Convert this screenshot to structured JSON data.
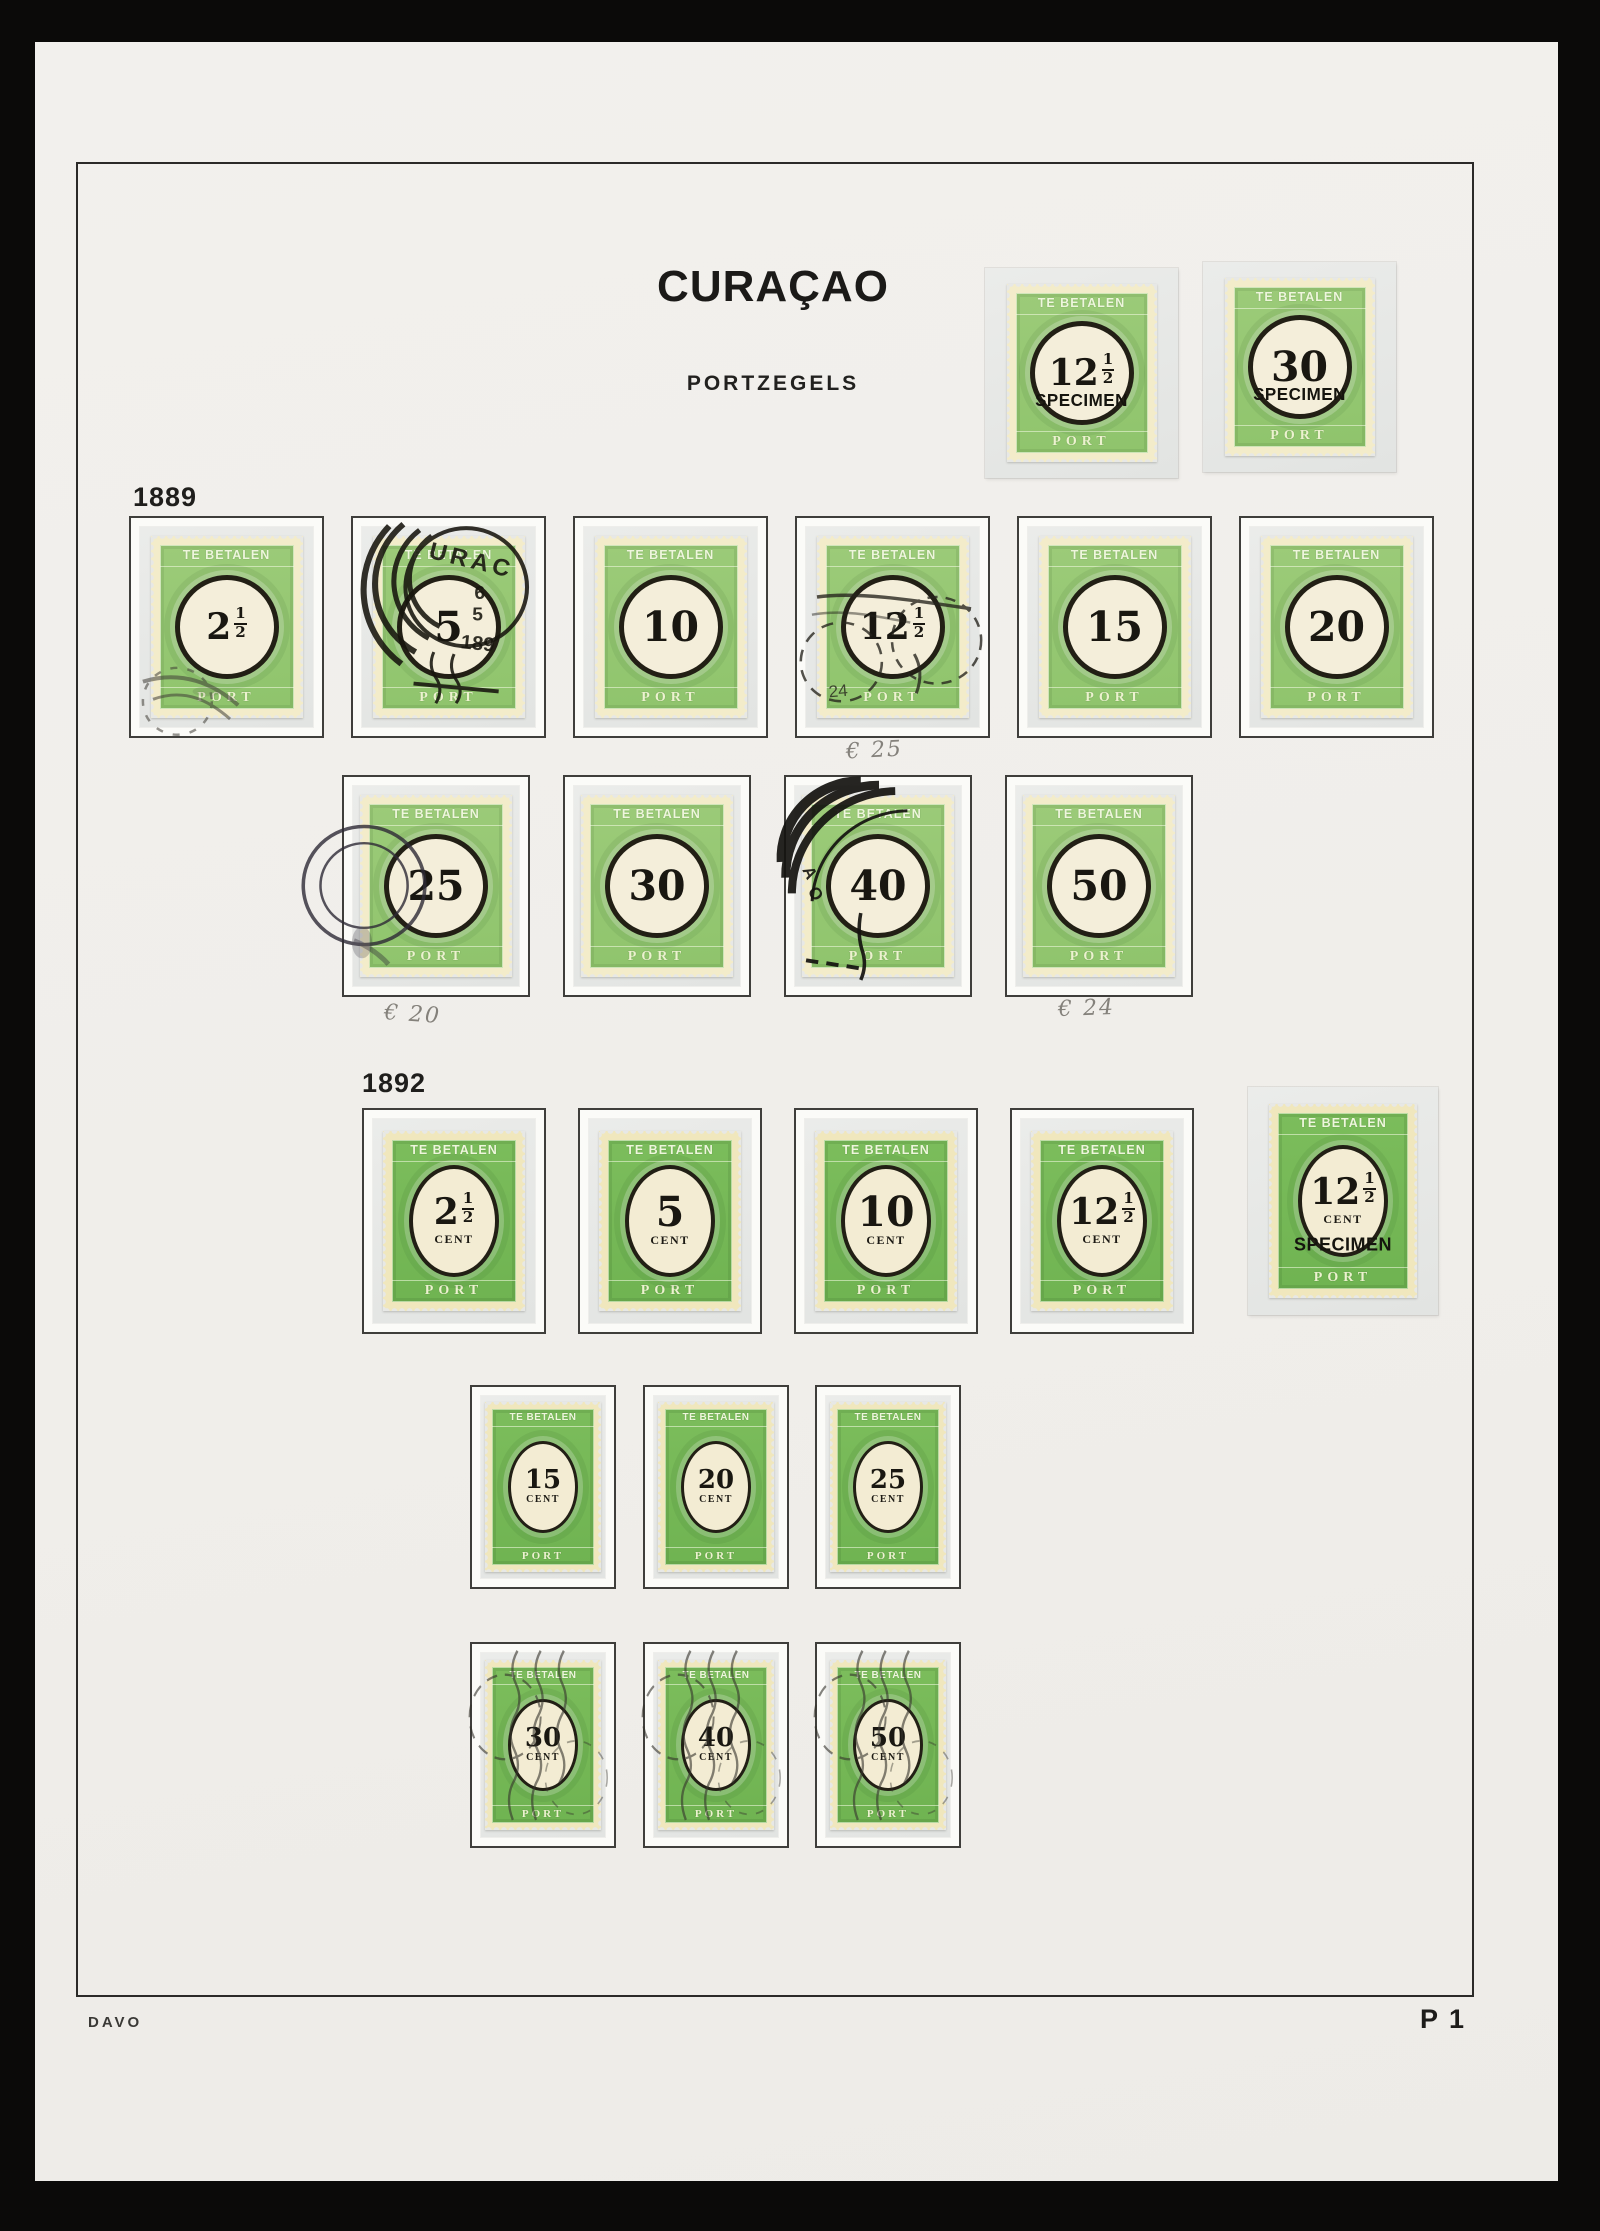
{
  "album": {
    "title": "CURAÇAO",
    "subtitle": "PORTZEGELS",
    "footer_left": "DAVO",
    "footer_right": "P 1"
  },
  "stamp_text": {
    "top": "TE BETALEN",
    "bottom": "PORT",
    "specimen": "SPECIMEN",
    "unit": "CENT"
  },
  "colors": {
    "backdrop": "#0b0a09",
    "page": "#f1efec",
    "frame_line": "#2b2a28",
    "box_border": "#3f3e3b",
    "mount": "#e7e8e6",
    "green_1889": "#95c672",
    "green_1892": "#75b756",
    "stamp_cream": "#f2eac6",
    "ink": "#191711",
    "pencil": "#84817b"
  },
  "top_specimens": [
    {
      "mount": [
        985,
        268,
        193,
        210
      ],
      "value_main": "12",
      "value_frac": "1/2",
      "specimen": true,
      "era": "1889"
    },
    {
      "mount": [
        1203,
        262,
        193,
        210
      ],
      "value_main": "30",
      "value_frac": "",
      "specimen": true,
      "era": "1889"
    }
  ],
  "sections": [
    {
      "year": "1889",
      "label_pos": [
        133,
        482
      ],
      "era": "1889",
      "rows": [
        {
          "y": 516,
          "h": 222,
          "stamp_w": 152,
          "stamp_h": 182,
          "stamps": [
            {
              "x": 129,
              "w": 195,
              "value_main": "2",
              "value_frac": "1/2",
              "cancel": "smudge-light"
            },
            {
              "x": 351,
              "w": 195,
              "value_main": "5",
              "value_frac": "",
              "cancel": "curacao",
              "cancel_texts": [
                "URAC",
                "6",
                "5",
                "189"
              ]
            },
            {
              "x": 573,
              "w": 195,
              "value_main": "10",
              "value_frac": ""
            },
            {
              "x": 795,
              "w": 195,
              "value_main": "12",
              "value_frac": "1/2",
              "cancel": "smudge",
              "cancel_texts": [
                "24"
              ]
            },
            {
              "x": 1017,
              "w": 195,
              "value_main": "15",
              "value_frac": ""
            },
            {
              "x": 1239,
              "w": 195,
              "value_main": "20",
              "value_frac": ""
            }
          ]
        },
        {
          "y": 775,
          "h": 222,
          "stamp_w": 152,
          "stamp_h": 182,
          "stamps": [
            {
              "x": 342,
              "w": 188,
              "value_main": "25",
              "value_frac": "",
              "cancel": "circle-left"
            },
            {
              "x": 563,
              "w": 188,
              "value_main": "30",
              "value_frac": ""
            },
            {
              "x": 784,
              "w": 188,
              "value_main": "40",
              "value_frac": "",
              "cancel": "corner-heavy",
              "cancel_texts": [
                "A",
                "O"
              ]
            },
            {
              "x": 1005,
              "w": 188,
              "value_main": "50",
              "value_frac": ""
            }
          ]
        }
      ]
    },
    {
      "year": "1892",
      "label_pos": [
        362,
        1068
      ],
      "era": "1892",
      "rows": [
        {
          "y": 1108,
          "h": 226,
          "stamp_w": 142,
          "stamp_h": 180,
          "stamps": [
            {
              "x": 362,
              "w": 184,
              "value_main": "2",
              "value_frac": "1/2",
              "unit": "CENT"
            },
            {
              "x": 578,
              "w": 184,
              "value_main": "5",
              "value_frac": "",
              "unit": "CENT"
            },
            {
              "x": 794,
              "w": 184,
              "value_main": "10",
              "value_frac": "",
              "unit": "CENT"
            },
            {
              "x": 1010,
              "w": 184,
              "value_main": "12",
              "value_frac": "1/2",
              "unit": "CENT"
            },
            {
              "x": 1248,
              "y": 1087,
              "w": 190,
              "h": 228,
              "mount_only": true,
              "stamp_w": 148,
              "stamp_h": 194,
              "value_main": "12",
              "value_frac": "1/2",
              "unit": "CENT",
              "specimen": true
            }
          ]
        },
        {
          "y": 1385,
          "h": 204,
          "stamp_w": 116,
          "stamp_h": 170,
          "stamps": [
            {
              "x": 470,
              "w": 146,
              "value_main": "15",
              "value_frac": "",
              "unit": "CENT"
            },
            {
              "x": 643,
              "w": 146,
              "value_main": "20",
              "value_frac": "",
              "unit": "CENT"
            },
            {
              "x": 815,
              "w": 146,
              "value_main": "25",
              "value_frac": "",
              "unit": "CENT"
            }
          ]
        },
        {
          "y": 1642,
          "h": 206,
          "stamp_w": 116,
          "stamp_h": 170,
          "stamps": [
            {
              "x": 470,
              "w": 146,
              "value_main": "30",
              "value_frac": "",
              "unit": "CENT",
              "cancel": "wavy"
            },
            {
              "x": 643,
              "w": 146,
              "value_main": "40",
              "value_frac": "",
              "unit": "CENT",
              "cancel": "wavy"
            },
            {
              "x": 815,
              "w": 146,
              "value_main": "50",
              "value_frac": "",
              "unit": "CENT",
              "cancel": "wavy"
            }
          ]
        }
      ]
    }
  ],
  "annotations": [
    {
      "text": "€ 25",
      "x": 846,
      "y": 738,
      "rot": -3
    },
    {
      "text": "€ 20",
      "x": 384,
      "y": 1002,
      "rot": 4
    },
    {
      "text": "€ 24",
      "x": 1058,
      "y": 996,
      "rot": -2
    }
  ]
}
